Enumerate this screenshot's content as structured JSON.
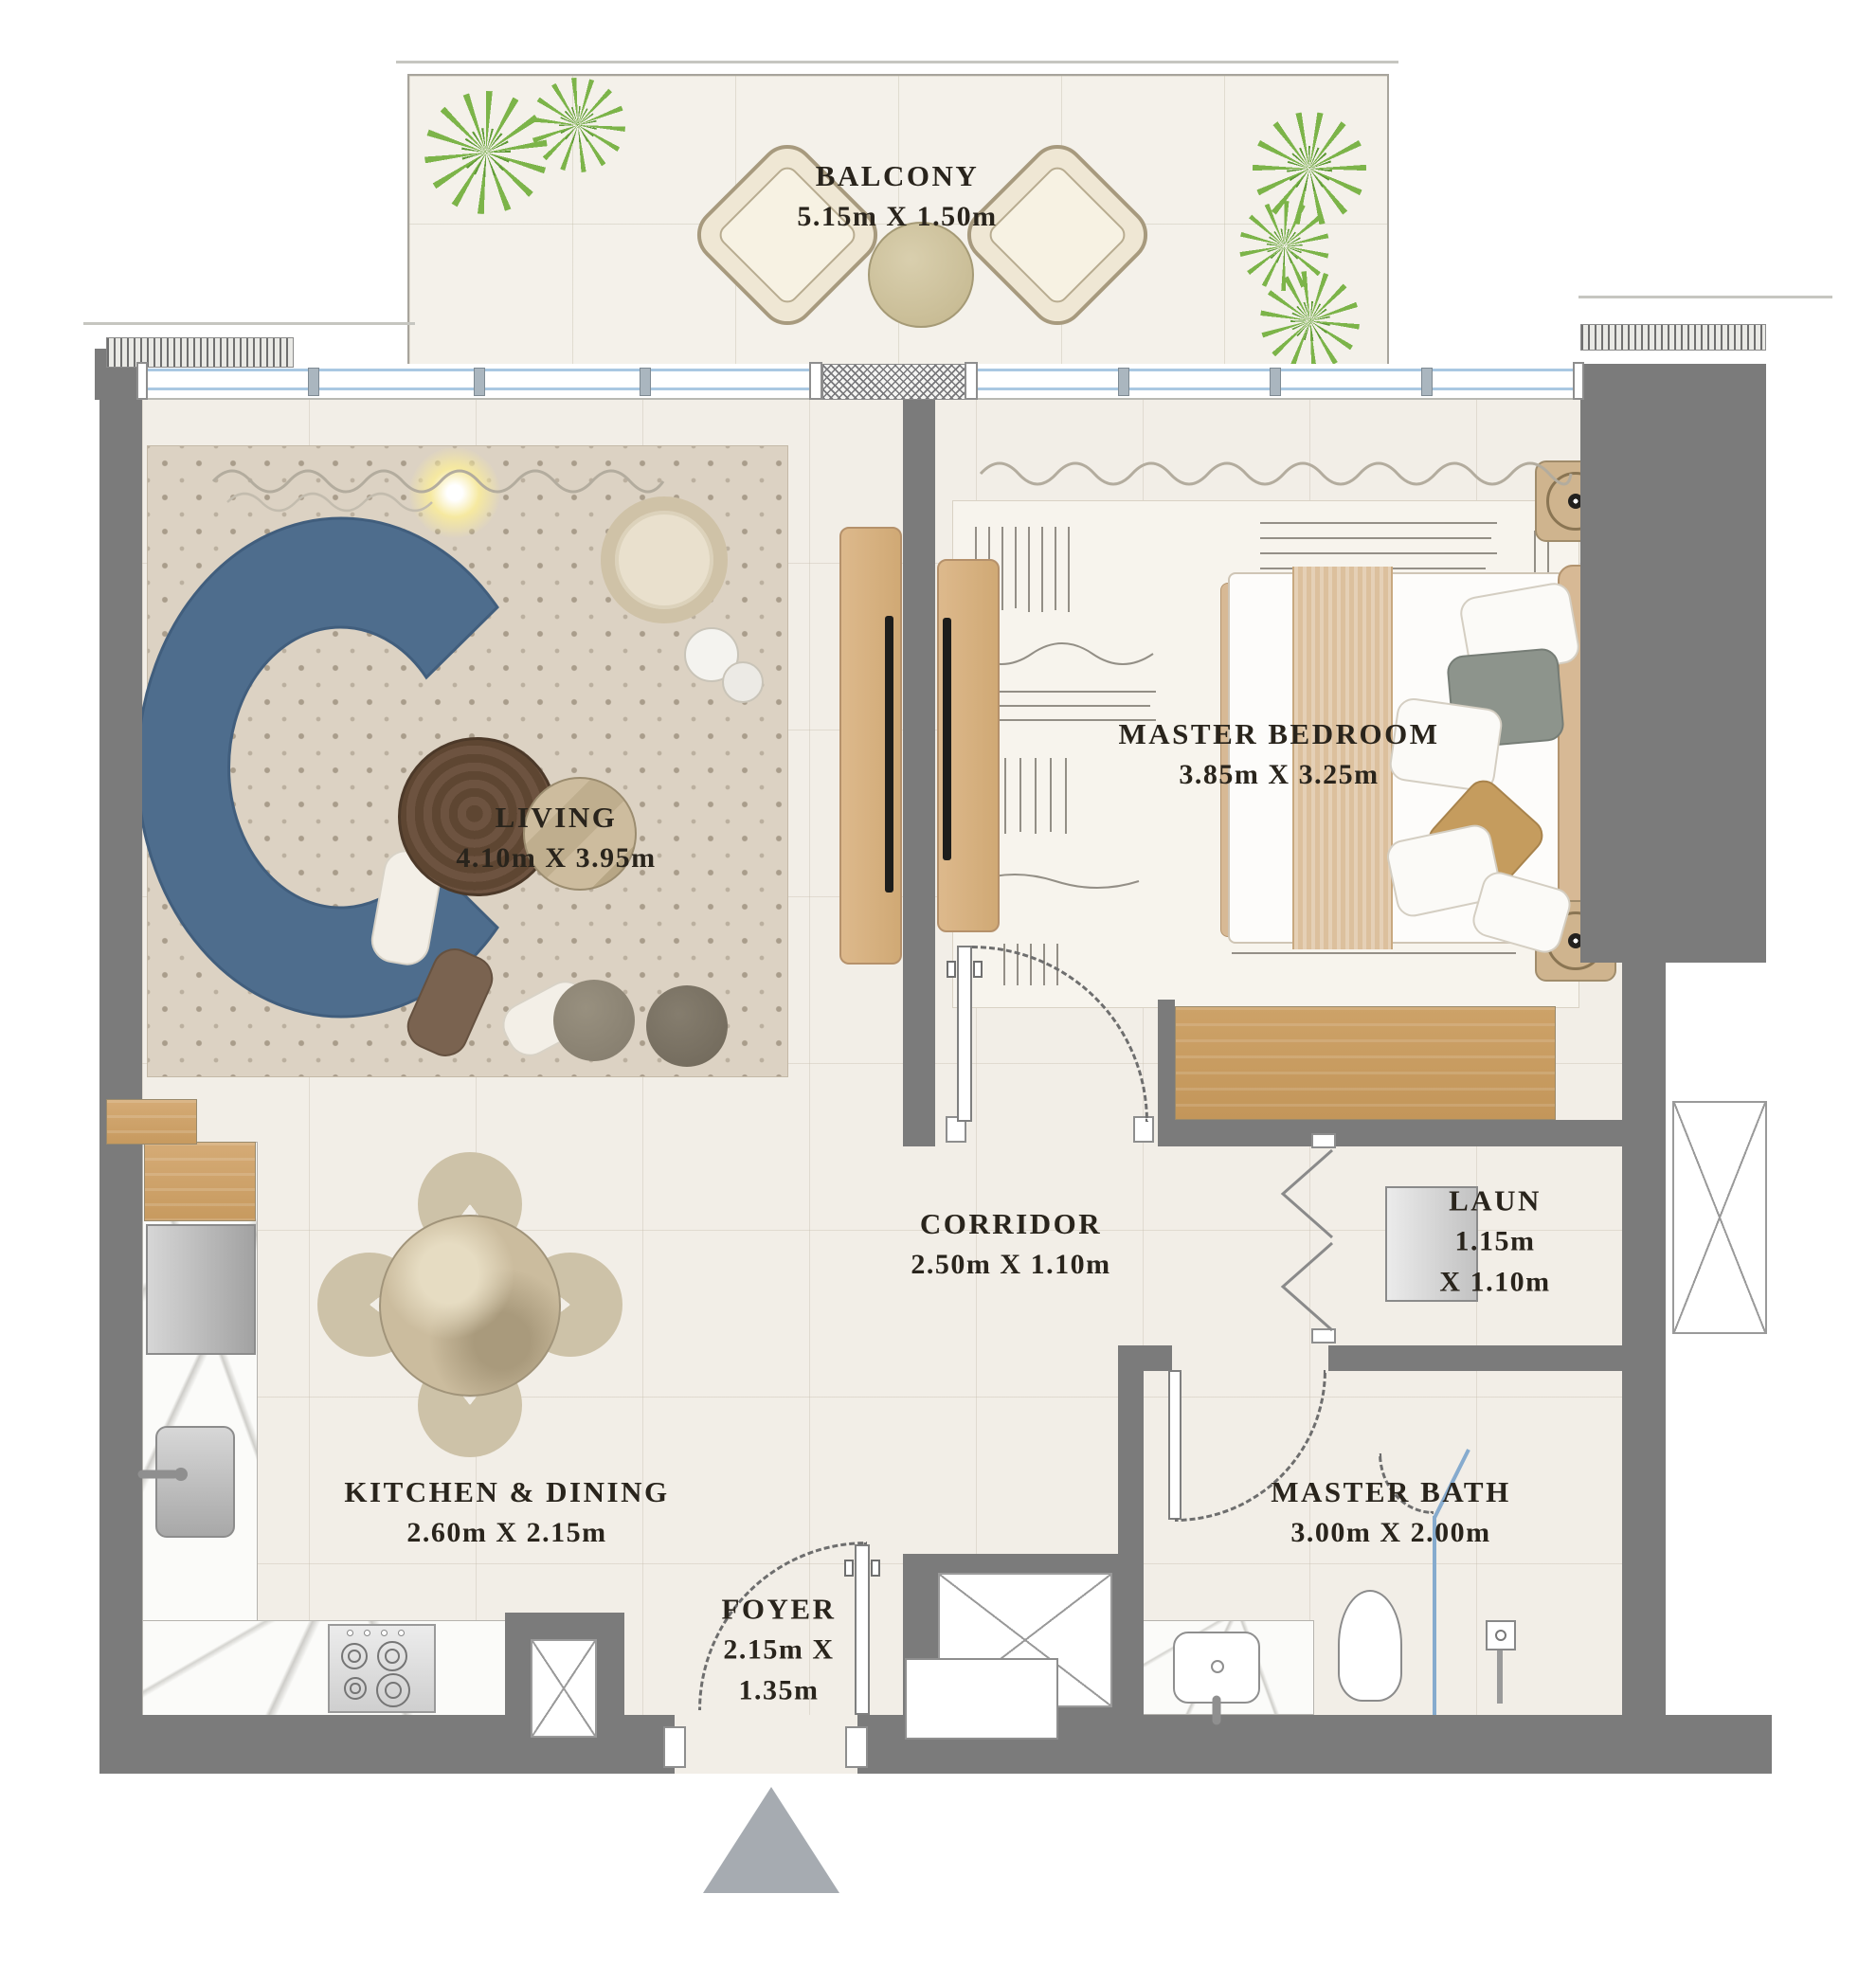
{
  "plan_type": "apartment floor plan",
  "rooms": [
    {
      "id": "balcony",
      "name": "BALCONY",
      "dims": "5.15m X 1.50m"
    },
    {
      "id": "living",
      "name": "LIVING",
      "dims": "4.10m X 3.95m"
    },
    {
      "id": "master_bedroom",
      "name": "MASTER BEDROOM",
      "dims": "3.85m X 3.25m"
    },
    {
      "id": "corridor",
      "name": "CORRIDOR",
      "dims": "2.50m X 1.10m"
    },
    {
      "id": "laundry",
      "name": "LAUN",
      "dims_line1": "1.15m",
      "dims_line2": "X 1.10m"
    },
    {
      "id": "kitchen_dining",
      "name": "KITCHEN & DINING",
      "dims": "2.60m X 2.15m"
    },
    {
      "id": "foyer",
      "name": "FOYER",
      "dims_line1": "2.15m X",
      "dims_line2": "1.35m"
    },
    {
      "id": "master_bath",
      "name": "MASTER BATH",
      "dims": "3.00m X 2.00m"
    }
  ],
  "colors": {
    "wall": "#7b7b7b",
    "floor": "#f2eee7",
    "window_glass": "#a9c8e2",
    "sofa": "#4e6d8d",
    "wood": "#d3a873",
    "plant": "#7cb449",
    "entry_arrow": "#a6abb1",
    "label_text": "#29241c"
  }
}
